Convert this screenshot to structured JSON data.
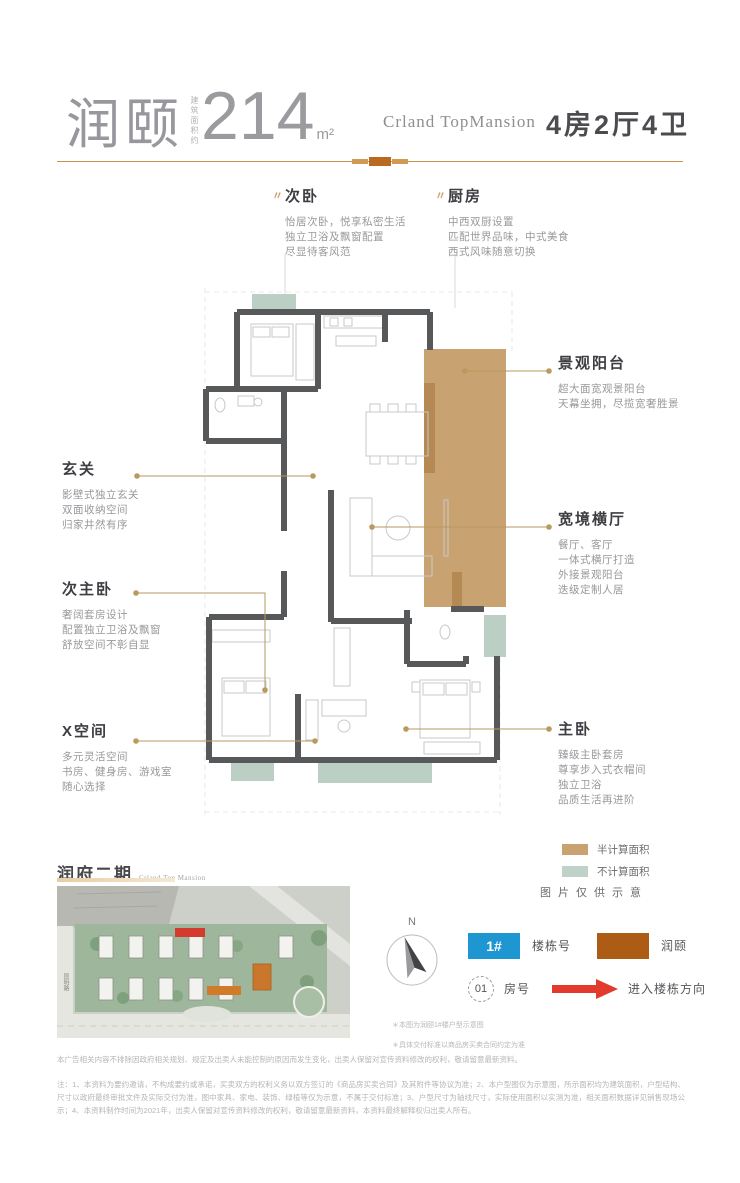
{
  "header": {
    "brand": "润颐",
    "area_label": "建筑面积约",
    "area_value": "214",
    "area_unit": "m²",
    "project_en": "Crland TopMansion",
    "spec": "4房2厅4卫"
  },
  "callouts": [
    {
      "title": "次卧",
      "lines": [
        "怡居次卧，悦享私密生活",
        "独立卫浴及飘窗配置",
        "尽显待客风范"
      ]
    },
    {
      "title": "厨房",
      "lines": [
        "中西双厨设置",
        "匹配世界品味，中式美食",
        "西式风味随意切换"
      ]
    },
    {
      "title": "景观阳台",
      "lines": [
        "超大面宽观景阳台",
        "天幕坐拥，尽揽宽奢胜景"
      ]
    },
    {
      "title": "玄关",
      "lines": [
        "影壁式独立玄关",
        "双面收纳空间",
        "归家井然有序"
      ]
    },
    {
      "title": "宽境横厅",
      "lines": [
        "餐厅、客厅",
        "一体式横厅打造",
        "外接景观阳台",
        "迭级定制人居"
      ]
    },
    {
      "title": "次主卧",
      "lines": [
        "奢阔套房设计",
        "配置独立卫浴及飘窗",
        "舒放空间不彰自显"
      ]
    },
    {
      "title": "X空间",
      "lines": [
        "多元灵活空间",
        "书房、健身房、游戏室",
        "随心选择"
      ]
    },
    {
      "title": "主卧",
      "lines": [
        "臻级主卧套房",
        "尊享步入式衣帽间",
        "独立卫浴",
        "品质生活再进阶"
      ]
    }
  ],
  "area_legend": {
    "half_label": "半计算面积",
    "half_color": "#c9a271",
    "uncounted_label": "不计算面积",
    "uncounted_color": "#bfd2c7",
    "note": "图片仅供示意"
  },
  "site_plan": {
    "title": "润府二期",
    "subtitle_en": "Crland Top Mansion",
    "road_label": "昆明路"
  },
  "compass": {
    "north_label": "N"
  },
  "map_legend": {
    "building_tag": "1#",
    "building_tag_color": "#1e96d2",
    "building_label": "楼栋号",
    "product_swatch_color": "#ad5c15",
    "product_label": "润颐",
    "room_tag": "01",
    "room_label": "房号",
    "arrow_color": "#e23a2c",
    "arrow_label": "进入楼栋方向"
  },
  "fine_print": {
    "note_1": "＊本图为润颐1#楼户型示意图",
    "note_2": "＊具体交付标准以商品房买卖合同约定为准",
    "para_1": "本广告相关内容不排除因政府相关规划、规定及出卖人未能控制的原因而发生变化，出卖人保留对宣传资料修改的权利，敬请留意最新资料。",
    "para_2": "注：1、本资料为要约邀请，不构成要约或承诺，买卖双方的权利义务以双方签订的《商品房买卖合同》及其附件等协议为准；2、本户型图仅为示意图，所示面积均为建筑面积，户型结构、尺寸以政府最终审批文件及实际交付为准，图中家具、家电、装饰、绿植等仅为示意，不属于交付标准；3、户型尺寸为轴线尺寸，实际使用面积以实测为准，相关面积数据详见销售现场公示；4、本资料制作时间为2021年，出卖人保留对宣传资料修改的权利，敬请留意最新资料，本资料最终解释权归出卖人所有。"
  },
  "plan_colors": {
    "wall": "#57585a",
    "balcony": "#c9a271",
    "bay_window": "#bccfc5",
    "leader": "#b99a5f"
  }
}
